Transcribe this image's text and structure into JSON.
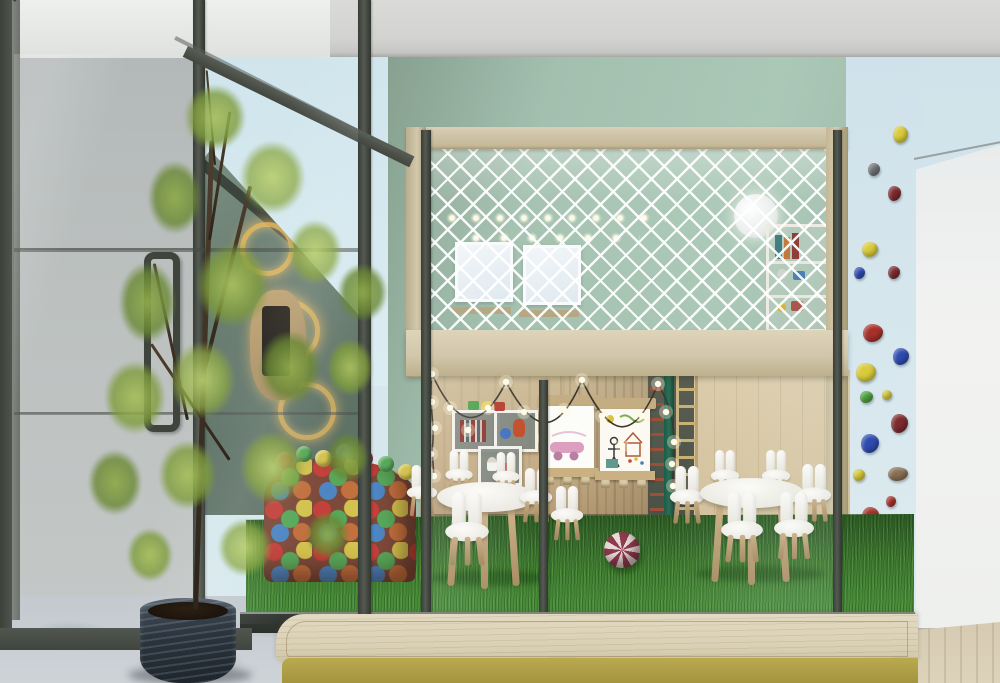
{
  "scene": {
    "description": "3D interior render of a children's playroom: a wooden mezzanine play loft with white safety netting, loft windows and a moon lamp; below it a play area with artificial grass, white bunny-ear kids chairs around two round tables, a striped ball, a colorful ball pit, kids drawing boards, a toy shelf, string lights and wall-bar ladders; on the right a pale blue climbing wall with multicolored holds; on the left an indoor tree in a dark planter behind a dark-framed glass partition; a light wooden platform bench in the foreground.",
    "palette": {
      "ceiling_gray": "#d4d5d2",
      "far_wall_blue": "#d3e7ee",
      "green_wall": "#a9c6b5",
      "net_white": "#ffffff",
      "mezzanine_wood": "#cfc3a6",
      "back_wall_wood": "#c3ab84",
      "grass_green": "#3f7a31",
      "glass_frame_dark": "#42463f",
      "concrete_floor": "#c9cfd4",
      "white_wall": "#eef0ef",
      "climbing_wall_blue": "#d4e5ec",
      "planter_dark": "#2b343d",
      "foliage_green": "#8fab4c",
      "platform_wood": "#ddd3ba",
      "platform_face_olive": "#b2a14a",
      "striped_ball_maroon": "#8e3b4e"
    },
    "climbing_hold_colors": [
      "#d9cb3a",
      "#6f7377",
      "#7c2a2e",
      "#2f4bb0",
      "#a8302a",
      "#4ea23e",
      "#8a7054"
    ],
    "ball_pit_colors": [
      "#c4403a",
      "#58a85a",
      "#d3c24e",
      "#4d86c2",
      "#c2703e"
    ],
    "objects": [
      "mezzanine play loft",
      "safety net",
      "loft windows",
      "moon lamp",
      "loft wall shelf",
      "string lights",
      "drawing boards",
      "marker ledges",
      "toy cube shelf",
      "toy train",
      "wall bars ladder",
      "kids round tables",
      "bunny ear chairs",
      "striped play ball",
      "ball pit",
      "artificial grass floor",
      "climbing wall holds",
      "indoor tree",
      "dark planter",
      "glass partition",
      "door handle",
      "wooden platform bench",
      "concrete floor"
    ]
  }
}
